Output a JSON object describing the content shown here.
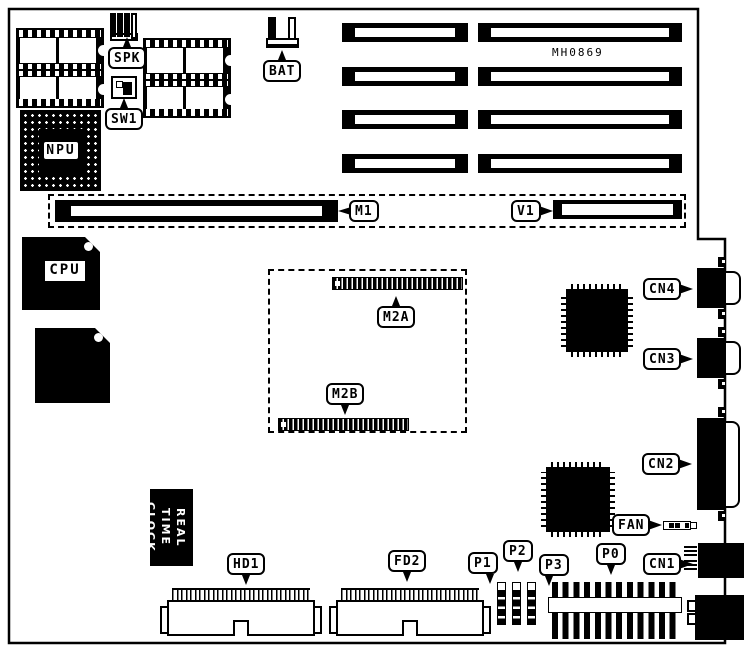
{
  "diagram": {
    "type": "motherboard-component-location-diagram",
    "part_number": "MH0869",
    "colors": {
      "ink": "#000000",
      "paper": "#ffffff"
    },
    "labels": {
      "spk": "SPK",
      "sw1": "SW1",
      "bat": "BAT",
      "npu": "NPU",
      "cpu": "CPU",
      "m1": "M1",
      "v1": "V1",
      "m2a": "M2A",
      "m2b": "M2B",
      "cn1": "CN1",
      "cn2": "CN2",
      "cn3": "CN3",
      "cn4": "CN4",
      "fan": "FAN",
      "p0": "P0",
      "p1": "P1",
      "p2": "P2",
      "p3": "P3",
      "hd1": "HD1",
      "fd2": "FD2",
      "rtc_line1": "REAL TIME",
      "rtc_line2": "CLOCK"
    }
  }
}
